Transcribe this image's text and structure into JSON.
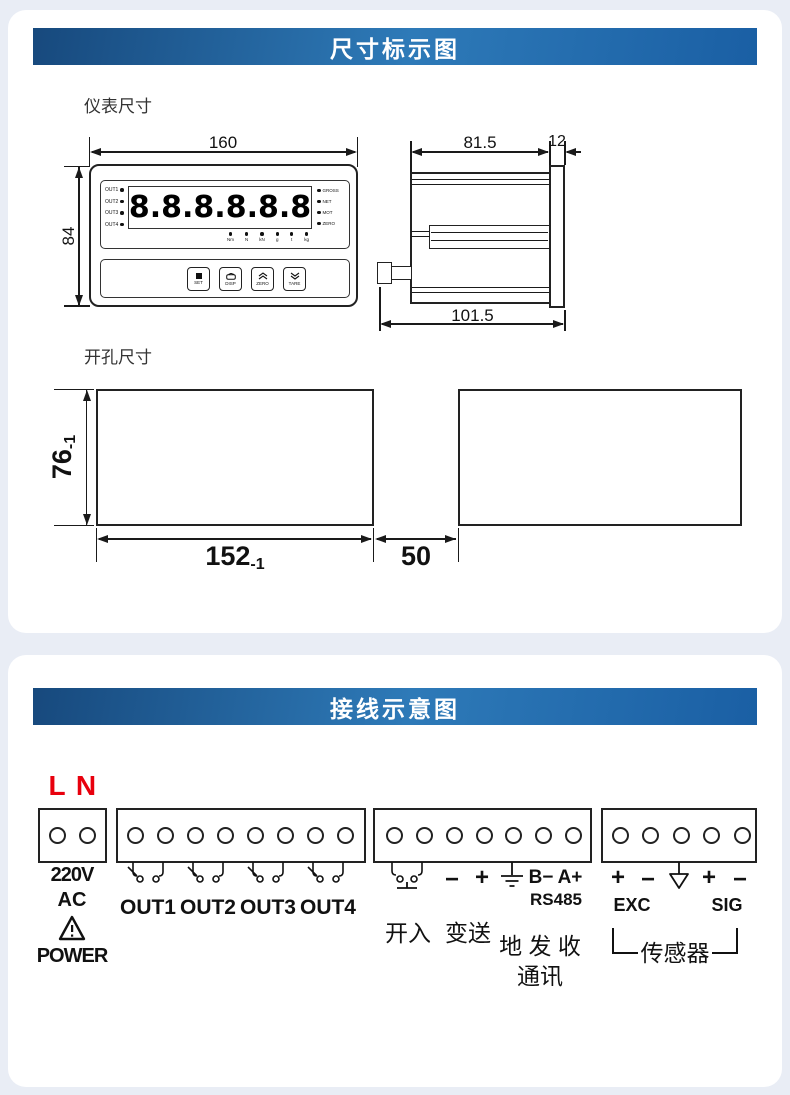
{
  "colors": {
    "page_bg": "#e9edf5",
    "header_gradient_start": "#17497d",
    "header_gradient_mid": "#2e7ab8",
    "header_gradient_end": "#1a5fa4",
    "accent_red": "#e8000d",
    "line": "#1a1a1a"
  },
  "section_dimensions": {
    "title": "尺寸标示图",
    "meter_size_label": "仪表尺寸",
    "cutout_size_label": "开孔尺寸",
    "front_view": {
      "width_dim": "160",
      "height_dim": "84",
      "display_value": "8.8.8.8.8.8",
      "out_indicators": [
        "OUT1",
        "OUT2",
        "OUT3",
        "OUT4"
      ],
      "status_indicators": [
        "GROSS",
        "NET",
        "MOT",
        "ZERO"
      ],
      "unit_indicators": [
        "Nm",
        "N",
        "kN",
        "g",
        "t",
        "kg"
      ],
      "buttons": [
        {
          "label": "SET"
        },
        {
          "label": "DISP"
        },
        {
          "label": "ZERO"
        },
        {
          "label": "TARE"
        }
      ]
    },
    "side_view": {
      "depth_dim": "81.5",
      "panel_dim": "12",
      "total_depth_dim": "101.5"
    },
    "cutout_view": {
      "height_dim": "76",
      "height_tol": "-1",
      "width_dim": "152",
      "width_tol": "-1",
      "gap_dim": "50"
    }
  },
  "section_wiring": {
    "title": "接线示意图",
    "power": {
      "l": "L",
      "n": "N",
      "voltage": "220V",
      "current_type": "AC",
      "label": "POWER"
    },
    "relay_outputs": [
      "OUT1",
      "OUT2",
      "OUT3",
      "OUT4"
    ],
    "io": {
      "minus": "−",
      "plus": "+",
      "b_minus": "B−",
      "a_plus": "A+",
      "bus": "RS485",
      "switch_input": "开入",
      "transmit": "变送",
      "gnd_tx_rx": "地 发 收",
      "comm": "通讯"
    },
    "sensor": {
      "exc_plus": "+",
      "exc_minus": "−",
      "sig_plus": "+",
      "sig_minus": "−",
      "exc": "EXC",
      "sig": "SIG",
      "label": "传感器"
    }
  }
}
